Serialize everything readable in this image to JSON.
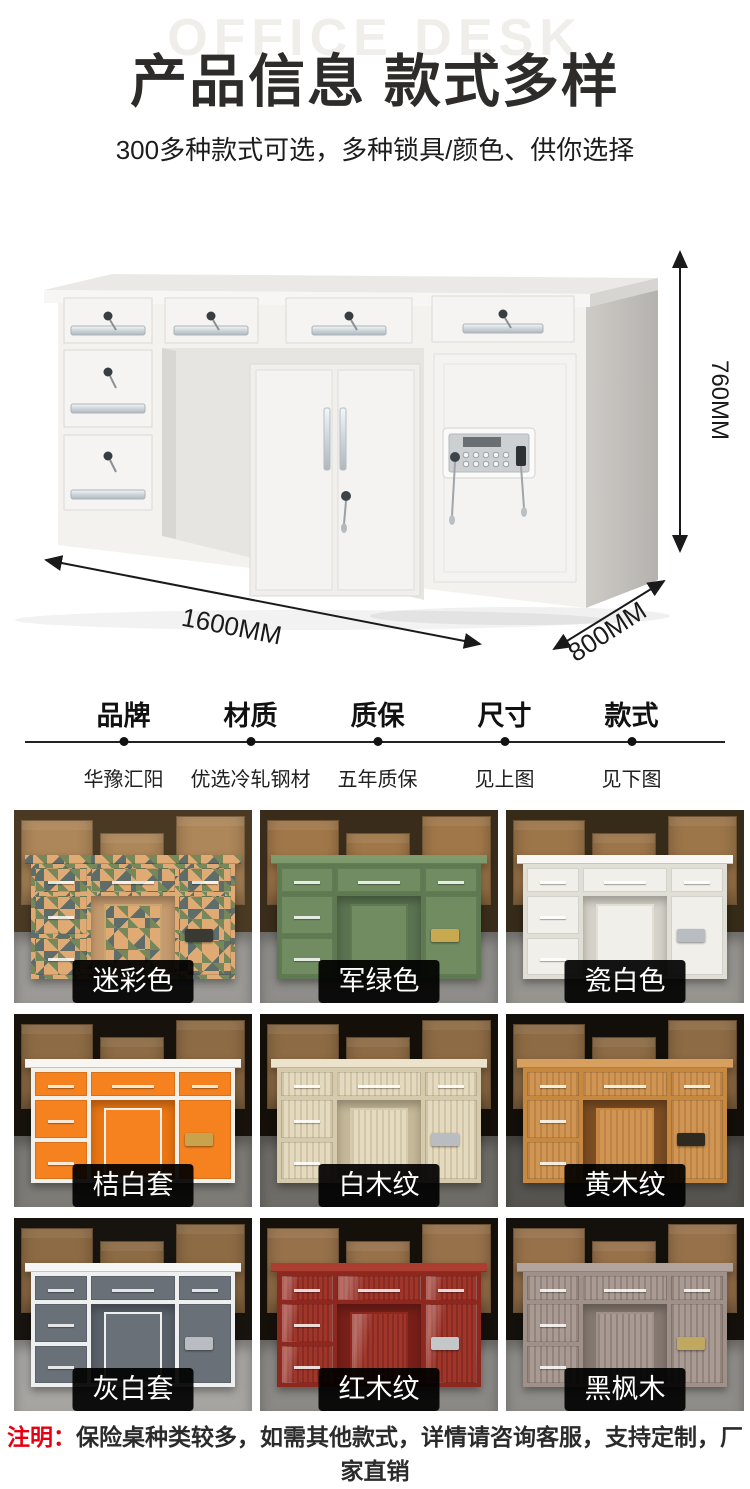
{
  "header": {
    "watermark": "OFFICE DESK",
    "title": "产品信息 款式多样",
    "subtitle": "300多种款式可选，多种锁具/颜色、供你选择"
  },
  "hero": {
    "dimensions": {
      "height": "760MM",
      "width": "1600MM",
      "depth": "800MM"
    }
  },
  "specs": {
    "columns": [
      {
        "label": "品牌",
        "value": "华豫汇阳"
      },
      {
        "label": "材质",
        "value": "优选冷轧钢材"
      },
      {
        "label": "质保",
        "value": "五年质保"
      },
      {
        "label": "尺寸",
        "value": "见上图"
      },
      {
        "label": "款式",
        "value": "见下图"
      }
    ]
  },
  "grid": {
    "tiles": [
      {
        "label": "迷彩色",
        "pattern": "camo",
        "colors": {
          "wall": "#4a3a24",
          "box": "#ad8659",
          "floor": "#9c9a96",
          "frame": "#c8a46e",
          "panel": "#e0aa74",
          "top": "#9aa06a",
          "interior": "#c59a6e",
          "lock": "#3a3a34",
          "grain": "rgba(0,0,0,0)"
        }
      },
      {
        "label": "军绿色",
        "pattern": "solid",
        "colors": {
          "wall": "#3a2c1a",
          "box": "#a07748",
          "floor": "#8e8d89",
          "frame": "#5f7a52",
          "panel": "#718c61",
          "top": "#7e9a6c",
          "interior": "#5a7350",
          "lock": "#c9a94f",
          "grain": "rgba(0,0,0,0)"
        }
      },
      {
        "label": "瓷白色",
        "pattern": "solid",
        "colors": {
          "wall": "#362a18",
          "box": "#9c7549",
          "floor": "#96948f",
          "frame": "#e0ded5",
          "panel": "#f0efe9",
          "top": "#f8f7f3",
          "interior": "#d5d3c9",
          "lock": "#b9bcc0",
          "grain": "rgba(0,0,0,0)"
        }
      },
      {
        "label": "桔白套",
        "pattern": "solid",
        "colors": {
          "wall": "#17120c",
          "box": "#8d6b44",
          "floor": "#7d7b76",
          "frame": "#f2f0ea",
          "panel": "#f5821f",
          "top": "#f7f6f2",
          "interior": "#e97513",
          "lock": "#c9a24e",
          "grain": "rgba(0,0,0,0)"
        }
      },
      {
        "label": "白木纹",
        "pattern": "wood",
        "colors": {
          "wall": "#141009",
          "box": "#8d6b44",
          "floor": "#6e6c66",
          "frame": "#d5caac",
          "panel": "#e4dabf",
          "top": "#ece3cc",
          "interior": "#c5b898",
          "lock": "#b9bcc0",
          "grain": "rgba(140,115,70,0.20)"
        }
      },
      {
        "label": "黄木纹",
        "pattern": "wood",
        "colors": {
          "wall": "#120e09",
          "box": "#8d6b44",
          "floor": "#56544f",
          "frame": "#c6893f",
          "panel": "#d09552",
          "top": "#d8a05f",
          "interior": "#7c4d22",
          "lock": "#2e2a1f",
          "grain": "rgba(120,70,25,0.22)"
        }
      },
      {
        "label": "灰白套",
        "pattern": "solid",
        "colors": {
          "wall": "#17130e",
          "box": "#8d6b44",
          "floor": "#a7a5a2",
          "frame": "#eef0ef",
          "panel": "#697078",
          "top": "#f5f6f5",
          "interior": "#596069",
          "lock": "#b9bcc0",
          "grain": "rgba(0,0,0,0)"
        }
      },
      {
        "label": "红木纹",
        "pattern": "gloss",
        "colors": {
          "wall": "#16100b",
          "box": "#97714a",
          "floor": "#8b8985",
          "frame": "#8e281e",
          "panel": "#a1352a",
          "top": "#ab3d31",
          "interior": "#771f18",
          "lock": "#c4c7ca",
          "grain": "rgba(0,0,0,0)"
        }
      },
      {
        "label": "黑枫木",
        "pattern": "wood",
        "colors": {
          "wall": "#14100b",
          "box": "#97714a",
          "floor": "#8f8d89",
          "frame": "#9f9189",
          "panel": "#a99b93",
          "top": "#b2a49c",
          "interior": "#857870",
          "lock": "#c0a860",
          "grain": "rgba(70,55,45,0.24)"
        }
      }
    ]
  },
  "note": {
    "prefix": "注明：",
    "text": "保险桌种类较多，如需其他款式，详情请咨询客服，支持定制，厂家直销",
    "accent_color": "#e60012"
  }
}
